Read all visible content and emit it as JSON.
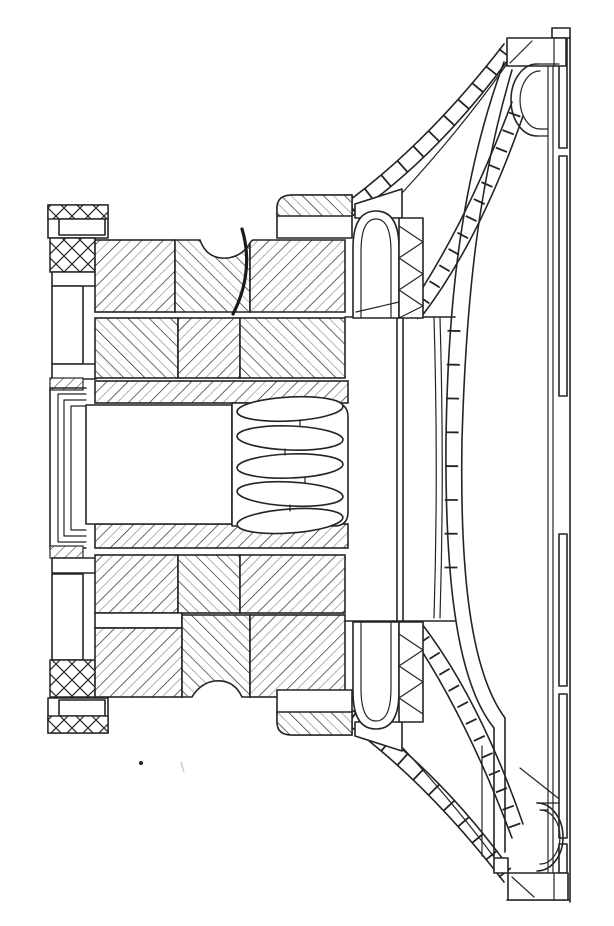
{
  "figure": {
    "subject": "Patent-style cross-section line drawing of a loudspeaker transducer",
    "drawing_style": "monochrome line art with section hatching",
    "palette": {
      "background": "#ffffff",
      "ink": "#242424",
      "hatch_light": "#b3b3b3"
    },
    "parts": {
      "back_plate_stack": "layered back plates and clamps at left",
      "magnet_upper": "upper hatched magnet and pole blocks",
      "magnet_lower": "lower hatched magnet and pole blocks",
      "pole_cavity": "open rectangular cavity in pole center",
      "spring_spider": "corrugated spring / spider lobes on axis",
      "voice_coil_former": "cylindrical former between coil ends",
      "voice_coil_upper": "upper coil arch with crimped winding",
      "voice_coil_lower": "lower coil arch with crimped winding",
      "cone_upper_section": "upper cut section of cone",
      "cone_lower_section": "lower cut section of cone",
      "cone_profile": "far-side cone silhouette curves",
      "frame_upper_arm": "upper basket arm in section",
      "frame_lower_arm": "lower basket arm in section",
      "surround_upper_roll": "upper half-roll surround",
      "surround_lower_roll": "lower half-roll surround",
      "gasket_upper": "upper gasket block",
      "gasket_lower": "lower gasket block",
      "mounting_flange": "vertical mounting flange at right",
      "lead_wire": "curved lead-out wire",
      "speck": "stray ink dot"
    }
  }
}
